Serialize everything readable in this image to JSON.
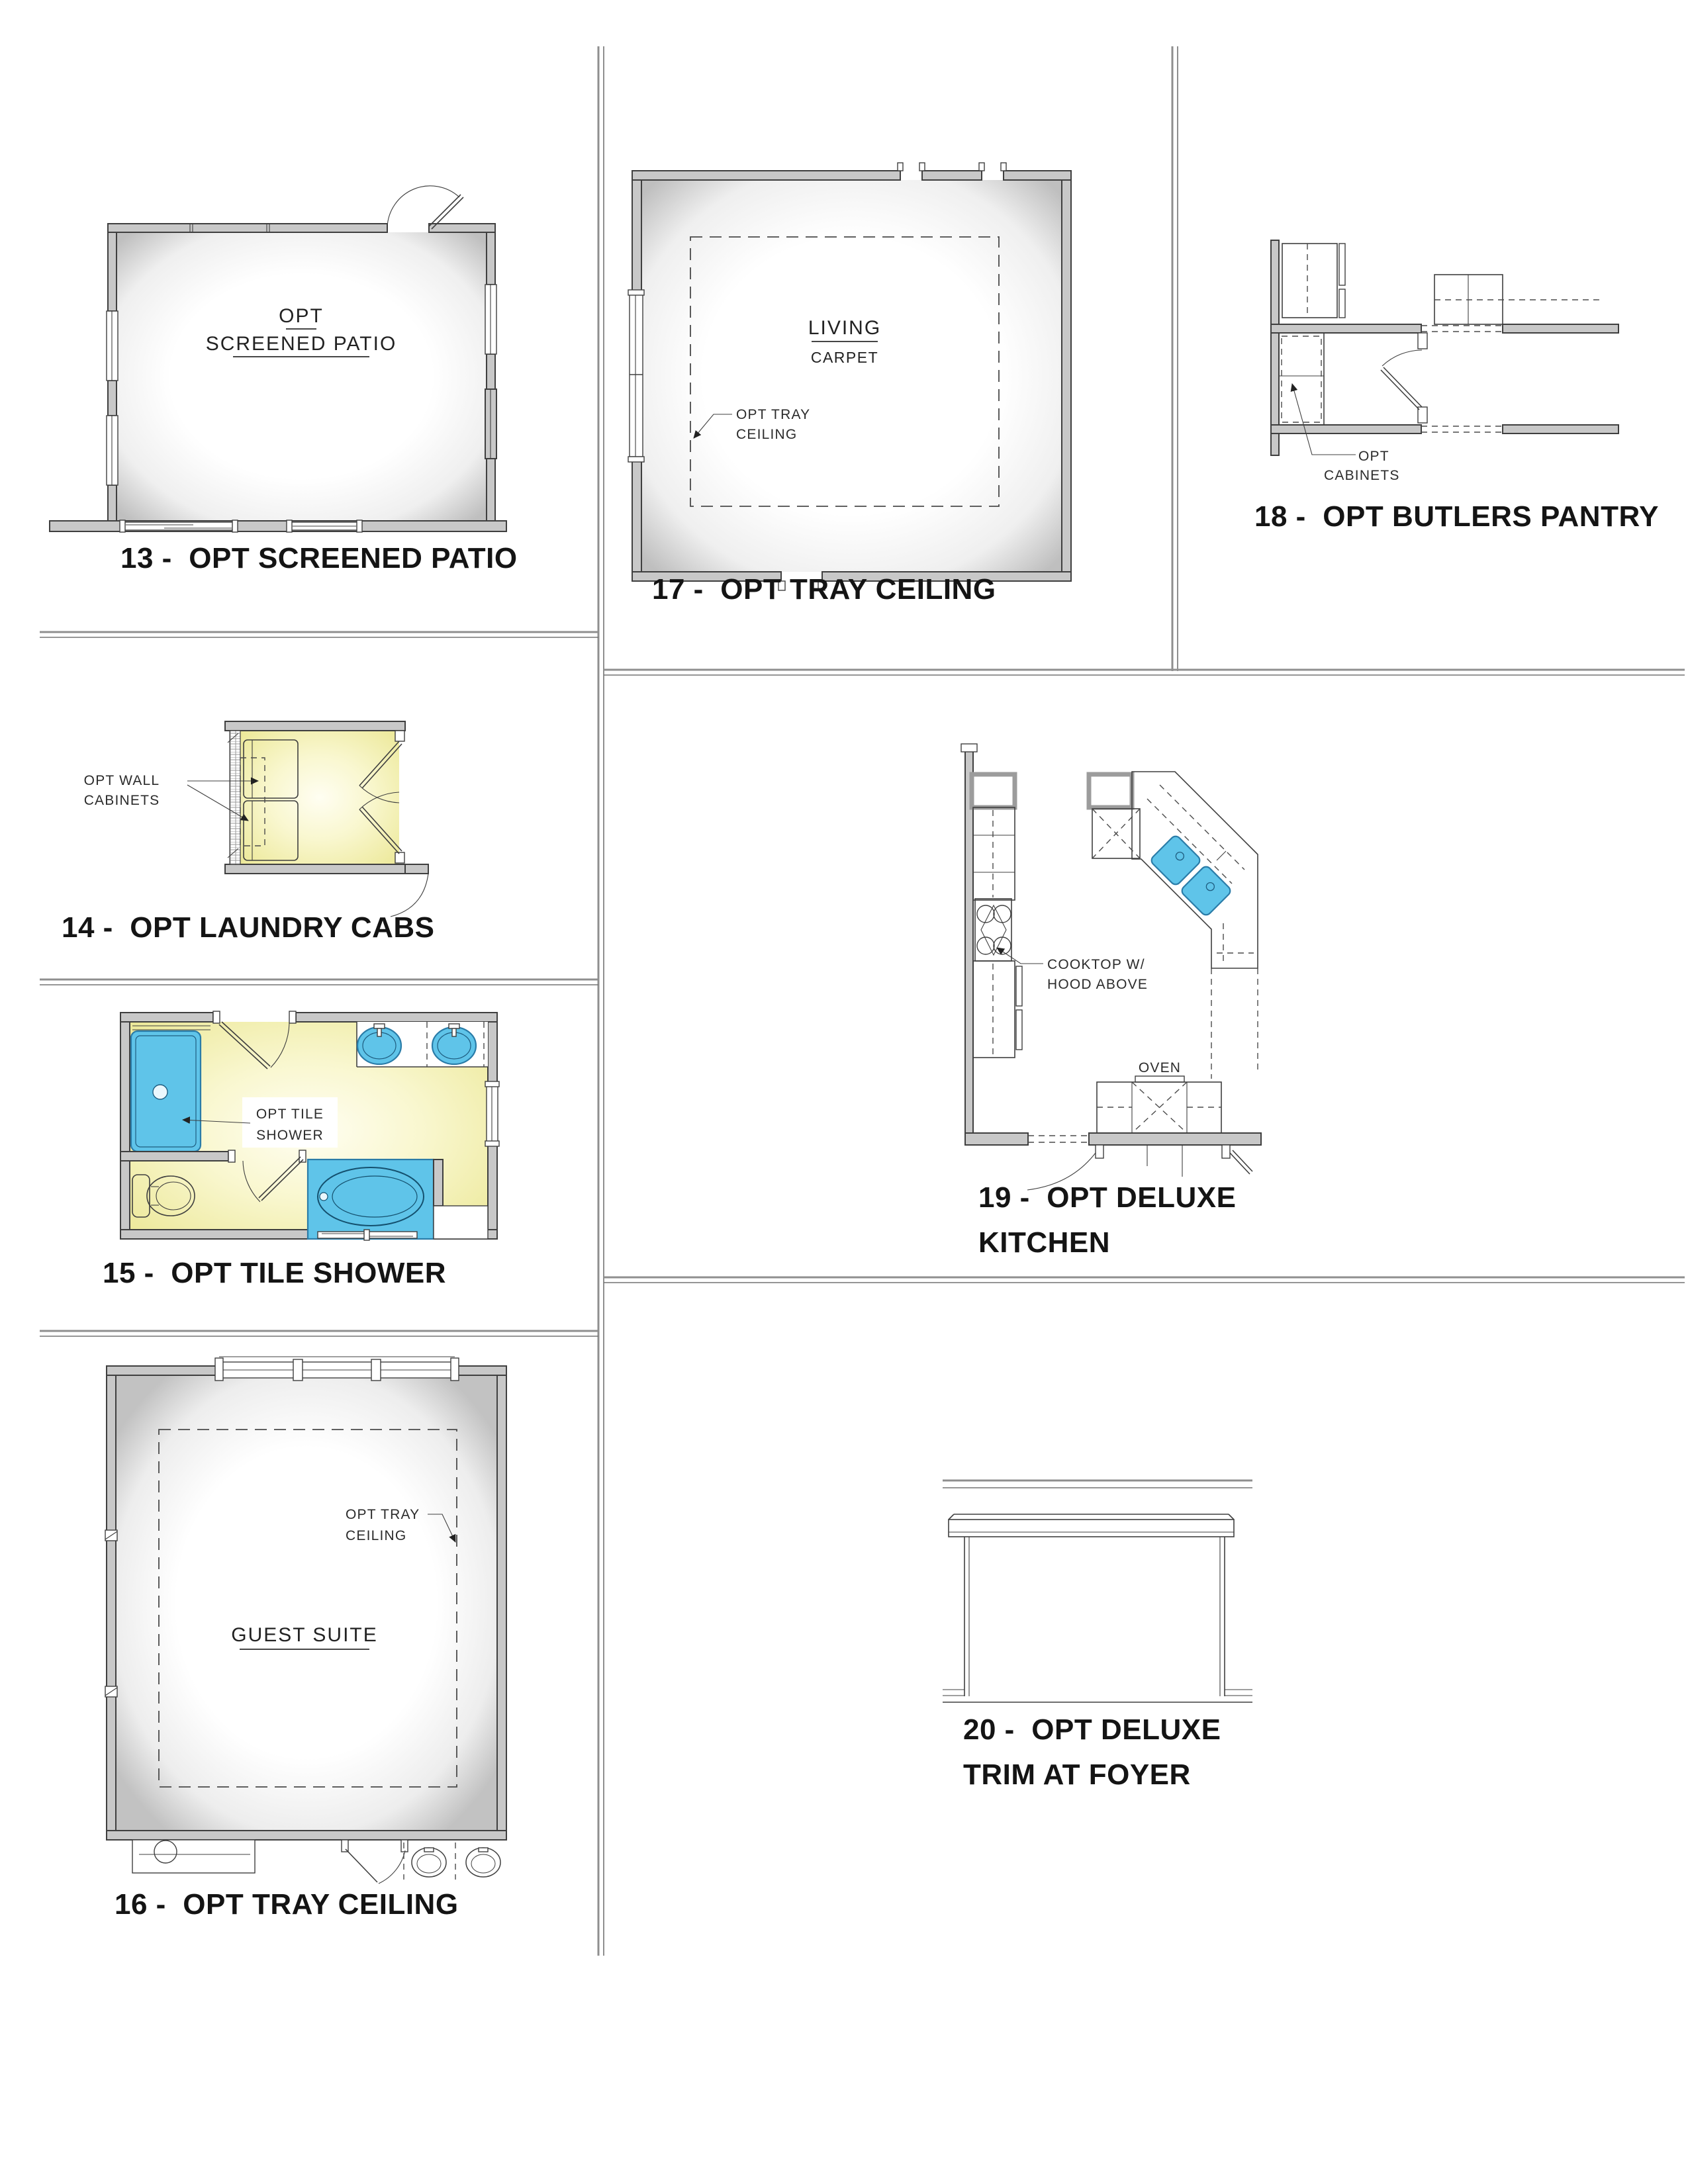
{
  "colors": {
    "wall_gray": "#c8c8c8",
    "highlight_yellow": "#f2efa0",
    "fixture_blue": "#5fc4e9",
    "divider_gray": "#8a8a8a",
    "text_dark": "#141414"
  },
  "panels": {
    "p13": {
      "caption": "13 -  OPT SCREENED PATIO",
      "room_line1": "OPT",
      "room_line2": "SCREENED PATIO"
    },
    "p14": {
      "caption": "14 -  OPT LAUNDRY CABS",
      "note_line1": "OPT WALL",
      "note_line2": "CABINETS"
    },
    "p15": {
      "caption": "15 -  OPT TILE SHOWER",
      "note_line1": "OPT TILE",
      "note_line2": "SHOWER"
    },
    "p16": {
      "caption": "16 -  OPT TRAY CEILING",
      "room": "GUEST SUITE",
      "note_line1": "OPT TRAY",
      "note_line2": "CEILING"
    },
    "p17": {
      "caption": "17 -  OPT TRAY CEILING",
      "room": "LIVING",
      "floor": "CARPET",
      "note_line1": "OPT TRAY",
      "note_line2": "CEILING"
    },
    "p18": {
      "caption": "18 -  OPT BUTLERS PANTRY",
      "note_line1": "OPT",
      "note_line2": "CABINETS"
    },
    "p19": {
      "caption_line1": "19 -  OPT DELUXE",
      "caption_line2": "KITCHEN",
      "note_line1": "COOKTOP W/",
      "note_line2": "HOOD ABOVE",
      "oven": "OVEN"
    },
    "p20": {
      "caption_line1": "20 -  OPT DELUXE",
      "caption_line2": "TRIM AT FOYER"
    }
  }
}
